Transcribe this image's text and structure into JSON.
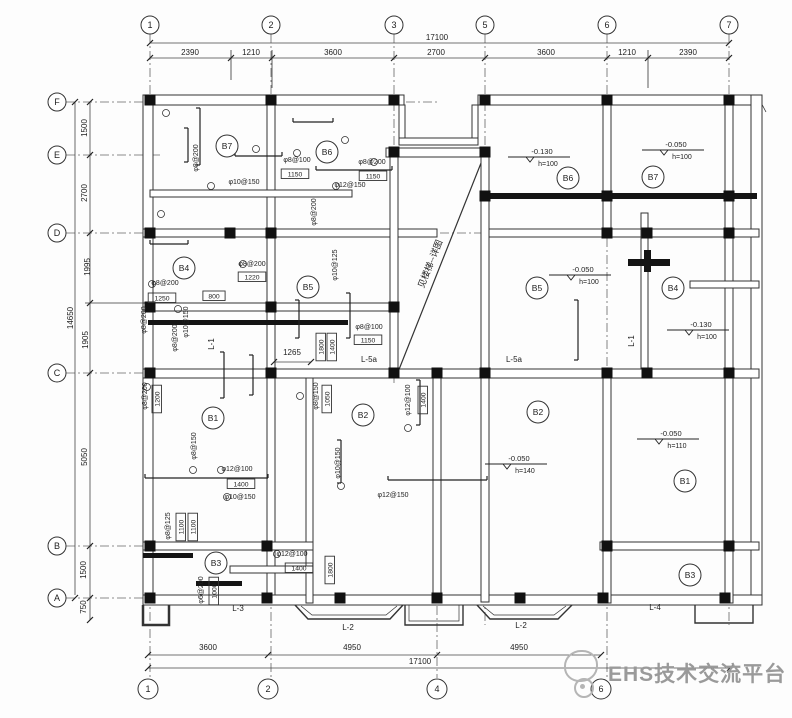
{
  "watermark": {
    "text": "EHS技术交流平台"
  },
  "drawing": {
    "gridlines": [
      [
        150,
        34,
        150,
        678
      ],
      [
        271,
        34,
        271,
        678
      ],
      [
        394,
        34,
        394,
        386
      ],
      [
        437,
        368,
        437,
        678
      ],
      [
        485,
        34,
        485,
        625
      ],
      [
        607,
        34,
        607,
        678
      ],
      [
        729,
        34,
        729,
        625
      ],
      [
        66,
        102,
        437,
        102
      ],
      [
        66,
        155,
        163,
        155
      ],
      [
        66,
        233,
        760,
        233
      ],
      [
        66,
        373,
        760,
        373
      ],
      [
        66,
        546,
        313,
        546
      ],
      [
        66,
        598,
        762,
        598
      ]
    ],
    "dimlines": [
      [
        150,
        43,
        729,
        43
      ],
      [
        150,
        58,
        729,
        58
      ],
      [
        148,
        655,
        601,
        655
      ],
      [
        148,
        668,
        730,
        668
      ],
      [
        90,
        102,
        90,
        620
      ],
      [
        75,
        102,
        75,
        595
      ],
      [
        274,
        362,
        311,
        362
      ]
    ],
    "lines": [
      [
        757,
        95,
        766,
        112
      ],
      [
        485,
        153,
        398,
        372,
        1.2
      ],
      [
        753,
        189,
        753,
        204,
        2
      ],
      [
        520,
        95,
        520,
        105
      ],
      [
        548,
        95,
        548,
        105
      ],
      [
        630,
        95,
        630,
        105
      ],
      [
        658,
        95,
        658,
        105
      ],
      [
        700,
        95,
        700,
        105
      ],
      [
        340,
        95,
        340,
        105
      ],
      [
        365,
        95,
        365,
        105
      ],
      [
        215,
        95,
        215,
        105
      ],
      [
        240,
        95,
        240,
        105
      ],
      [
        143,
        130,
        153,
        130
      ],
      [
        143,
        160,
        153,
        160
      ],
      [
        143,
        410,
        153,
        410
      ],
      [
        143,
        440,
        153,
        440
      ],
      [
        143,
        470,
        153,
        470
      ],
      [
        751,
        300,
        762,
        300
      ],
      [
        751,
        330,
        762,
        330
      ],
      [
        751,
        470,
        762,
        470
      ],
      [
        751,
        500,
        762,
        500
      ],
      [
        231,
        50,
        231,
        80
      ],
      [
        272,
        50,
        272,
        88
      ],
      [
        648,
        50,
        648,
        88
      ],
      [
        85,
        303,
        148,
        303
      ]
    ],
    "walls": [
      [
        143,
        95,
        261,
        10
      ],
      [
        386,
        148,
        103,
        9
      ],
      [
        399,
        105,
        6,
        38
      ],
      [
        472,
        105,
        6,
        38
      ],
      [
        399,
        138,
        79,
        7
      ],
      [
        478,
        95,
        284,
        10
      ],
      [
        751,
        95,
        11,
        510
      ],
      [
        143,
        95,
        10,
        510
      ],
      [
        143,
        595,
        619,
        10
      ],
      [
        267,
        105,
        8,
        490
      ],
      [
        150,
        190,
        202,
        7
      ],
      [
        143,
        229,
        294,
        8
      ],
      [
        485,
        229,
        274,
        8
      ],
      [
        143,
        303,
        255,
        8
      ],
      [
        390,
        150,
        8,
        228
      ],
      [
        481,
        150,
        8,
        452
      ],
      [
        603,
        105,
        8,
        130
      ],
      [
        603,
        373,
        8,
        230
      ],
      [
        641,
        213,
        7,
        163
      ],
      [
        725,
        105,
        8,
        498
      ],
      [
        143,
        369,
        616,
        9
      ],
      [
        433,
        378,
        8,
        225
      ],
      [
        306,
        378,
        7,
        225
      ],
      [
        143,
        542,
        170,
        8
      ],
      [
        600,
        542,
        159,
        8
      ],
      [
        230,
        566,
        83,
        7
      ],
      [
        690,
        281,
        69,
        7
      ]
    ],
    "solids": [
      [
        480,
        193,
        277,
        6
      ],
      [
        148,
        320,
        200,
        5
      ],
      [
        143,
        553,
        50,
        5
      ],
      [
        196,
        581,
        46,
        5
      ],
      [
        628,
        259,
        42,
        7
      ],
      [
        644,
        250,
        7,
        22
      ]
    ],
    "columns": [
      [
        150,
        100
      ],
      [
        271,
        100
      ],
      [
        394,
        100
      ],
      [
        485,
        100
      ],
      [
        607,
        100
      ],
      [
        729,
        100
      ],
      [
        394,
        152
      ],
      [
        485,
        152
      ],
      [
        485,
        196
      ],
      [
        607,
        196
      ],
      [
        729,
        196
      ],
      [
        150,
        233
      ],
      [
        230,
        233
      ],
      [
        271,
        233
      ],
      [
        607,
        233
      ],
      [
        647,
        233
      ],
      [
        729,
        233
      ],
      [
        150,
        307
      ],
      [
        271,
        307
      ],
      [
        394,
        307
      ],
      [
        150,
        373
      ],
      [
        271,
        373
      ],
      [
        394,
        373
      ],
      [
        437,
        373
      ],
      [
        485,
        373
      ],
      [
        607,
        373
      ],
      [
        647,
        373
      ],
      [
        729,
        373
      ],
      [
        150,
        546
      ],
      [
        267,
        546
      ],
      [
        607,
        546
      ],
      [
        729,
        546
      ],
      [
        150,
        598
      ],
      [
        267,
        598
      ],
      [
        340,
        598
      ],
      [
        437,
        598
      ],
      [
        520,
        598
      ],
      [
        603,
        598
      ],
      [
        725,
        598
      ]
    ],
    "polys": [
      {
        "w": 2.5,
        "pts": [
          [
            143,
            605
          ],
          [
            143,
            625
          ],
          [
            169,
            625
          ],
          [
            169,
            605
          ]
        ]
      },
      {
        "w": 1.4,
        "pts": [
          [
            295,
            605
          ],
          [
            308,
            619
          ],
          [
            390,
            619
          ],
          [
            403,
            605
          ]
        ]
      },
      {
        "w": 0.7,
        "pts": [
          [
            301,
            606
          ],
          [
            312,
            615
          ],
          [
            386,
            615
          ],
          [
            397,
            606
          ]
        ]
      },
      {
        "w": 1.4,
        "pts": [
          [
            405,
            605
          ],
          [
            405,
            625
          ],
          [
            463,
            625
          ],
          [
            463,
            605
          ]
        ]
      },
      {
        "w": 0.7,
        "pts": [
          [
            409,
            605
          ],
          [
            409,
            621
          ],
          [
            459,
            621
          ],
          [
            459,
            605
          ]
        ]
      },
      {
        "w": 1.4,
        "pts": [
          [
            477,
            605
          ],
          [
            490,
            619
          ],
          [
            558,
            619
          ],
          [
            572,
            605
          ]
        ]
      },
      {
        "w": 0.7,
        "pts": [
          [
            483,
            606
          ],
          [
            494,
            615
          ],
          [
            554,
            615
          ],
          [
            566,
            606
          ]
        ]
      },
      {
        "w": 1.4,
        "pts": [
          [
            695,
            605
          ],
          [
            695,
            623
          ],
          [
            753,
            623
          ],
          [
            753,
            605
          ]
        ]
      }
    ],
    "hooks": [
      [
        150,
        244,
        188,
        244
      ],
      [
        235,
        156,
        282,
        156
      ],
      [
        316,
        170,
        392,
        170
      ],
      [
        145,
        478,
        268,
        478
      ],
      [
        293,
        122,
        333,
        122
      ],
      [
        388,
        480,
        487,
        480
      ],
      [
        200,
        108,
        200,
        165
      ],
      [
        224,
        352,
        224,
        398
      ],
      [
        253,
        355,
        253,
        395
      ],
      [
        299,
        300,
        299,
        338
      ],
      [
        350,
        293,
        350,
        338
      ],
      [
        578,
        300,
        578,
        360
      ],
      [
        188,
        128,
        188,
        162
      ],
      [
        341,
        440,
        341,
        483
      ],
      [
        420,
        380,
        420,
        425
      ]
    ],
    "ticks": [
      [
        150,
        43
      ],
      [
        729,
        43
      ],
      [
        150,
        58
      ],
      [
        231,
        58
      ],
      [
        272,
        58
      ],
      [
        394,
        58
      ],
      [
        485,
        58
      ],
      [
        607,
        58
      ],
      [
        648,
        58
      ],
      [
        729,
        58
      ],
      [
        148,
        655
      ],
      [
        268,
        655
      ],
      [
        437,
        655
      ],
      [
        601,
        655
      ],
      [
        148,
        668
      ],
      [
        730,
        668
      ],
      [
        90,
        102
      ],
      [
        90,
        155
      ],
      [
        90,
        233
      ],
      [
        90,
        303
      ],
      [
        90,
        373
      ],
      [
        90,
        546
      ],
      [
        90,
        598
      ],
      [
        90,
        620
      ],
      [
        75,
        102
      ],
      [
        75,
        598
      ],
      [
        274,
        362
      ],
      [
        311,
        362
      ]
    ],
    "refs": [
      [
        166,
        113
      ],
      [
        256,
        149
      ],
      [
        211,
        186
      ],
      [
        161,
        214
      ],
      [
        297,
        153
      ],
      [
        345,
        140
      ],
      [
        243,
        264
      ],
      [
        152,
        284
      ],
      [
        178,
        309
      ],
      [
        147,
        387
      ],
      [
        193,
        470
      ],
      [
        221,
        470
      ],
      [
        227,
        497
      ],
      [
        277,
        554
      ],
      [
        300,
        396
      ],
      [
        341,
        486
      ],
      [
        374,
        162
      ],
      [
        336,
        186
      ],
      [
        408,
        428
      ]
    ],
    "bubbles": [
      [
        150,
        25,
        9,
        "1"
      ],
      [
        271,
        25,
        9,
        "2"
      ],
      [
        394,
        25,
        9,
        "3"
      ],
      [
        485,
        25,
        9,
        "5"
      ],
      [
        607,
        25,
        9,
        "6"
      ],
      [
        729,
        25,
        9,
        "7"
      ],
      [
        148,
        689,
        10,
        "1"
      ],
      [
        268,
        689,
        10,
        "2"
      ],
      [
        437,
        689,
        10,
        "4"
      ],
      [
        601,
        689,
        10,
        "6"
      ],
      [
        57,
        102,
        9,
        "F"
      ],
      [
        57,
        155,
        9,
        "E"
      ],
      [
        57,
        233,
        9,
        "D"
      ],
      [
        57,
        373,
        9,
        "C"
      ],
      [
        57,
        546,
        9,
        "B"
      ],
      [
        57,
        598,
        9,
        "A"
      ]
    ],
    "rooms": [
      [
        227,
        146,
        "B7"
      ],
      [
        327,
        152,
        "B6"
      ],
      [
        184,
        268,
        "B4"
      ],
      [
        308,
        287,
        "B5"
      ],
      [
        213,
        418,
        "B1"
      ],
      [
        363,
        415,
        "B2"
      ],
      [
        216,
        563,
        "B3"
      ],
      [
        568,
        178,
        "B6"
      ],
      [
        653,
        177,
        "B7"
      ],
      [
        537,
        288,
        "B5"
      ],
      [
        673,
        288,
        "B4"
      ],
      [
        538,
        412,
        "B2"
      ],
      [
        685,
        481,
        "B1"
      ],
      [
        690,
        575,
        "B3"
      ]
    ],
    "texts": [
      [
        437,
        40,
        "17100"
      ],
      [
        190,
        55,
        "2390"
      ],
      [
        251,
        55,
        "1210"
      ],
      [
        333,
        55,
        "3600"
      ],
      [
        436,
        55,
        "2700"
      ],
      [
        546,
        55,
        "3600"
      ],
      [
        627,
        55,
        "1210"
      ],
      [
        688,
        55,
        "2390"
      ],
      [
        208,
        650,
        "3600"
      ],
      [
        352,
        650,
        "4950"
      ],
      [
        519,
        650,
        "4950"
      ],
      [
        420,
        664,
        "17100"
      ],
      [
        87,
        128,
        "1500",
        -90
      ],
      [
        87,
        193,
        "2700",
        -90
      ],
      [
        90,
        267,
        "1995",
        -90
      ],
      [
        88,
        340,
        "1905",
        -90
      ],
      [
        87,
        457,
        "5050",
        -90
      ],
      [
        86,
        570,
        "1500",
        -90
      ],
      [
        86,
        607,
        "750",
        -90
      ],
      [
        73,
        318,
        "14650",
        -90
      ],
      [
        292,
        355,
        "1265"
      ],
      [
        214,
        344,
        "L-1",
        -90
      ],
      [
        634,
        341,
        "L-1",
        -90
      ],
      [
        369,
        362,
        "L-5a"
      ],
      [
        514,
        362,
        "L-5a"
      ],
      [
        348,
        630,
        "L-2"
      ],
      [
        521,
        628,
        "L-2"
      ],
      [
        238,
        611,
        "L-3"
      ],
      [
        655,
        610,
        "L-4"
      ],
      [
        198,
        158,
        "φ8@200",
        -90,
        7
      ],
      [
        244,
        184,
        "φ10@150",
        0,
        7
      ],
      [
        297,
        162,
        "φ8@100",
        0,
        7
      ],
      [
        372,
        164,
        "φ8@200",
        0,
        7
      ],
      [
        350,
        187,
        "φ12@150",
        0,
        7
      ],
      [
        252,
        266,
        "φ8@200",
        0,
        7
      ],
      [
        337,
        265,
        "φ10@125",
        -90,
        7
      ],
      [
        165,
        285,
        "φ8@200",
        0,
        7
      ],
      [
        177,
        338,
        "φ8@200",
        -90,
        7
      ],
      [
        188,
        322,
        "φ10@150",
        -90,
        7
      ],
      [
        146,
        320,
        "φ8@200",
        -90,
        7
      ],
      [
        147,
        396,
        "φ8@200",
        -90,
        7
      ],
      [
        196,
        446,
        "φ8@150",
        -90,
        7
      ],
      [
        318,
        396,
        "φ8@150",
        -90,
        7
      ],
      [
        237,
        471,
        "φ12@100",
        0,
        7
      ],
      [
        240,
        499,
        "φ10@150",
        0,
        7
      ],
      [
        292,
        556,
        "φ12@100",
        0,
        7
      ],
      [
        203,
        590,
        "φ6@200",
        -90,
        7
      ],
      [
        170,
        526,
        "φ8@125",
        -90,
        7
      ],
      [
        340,
        463,
        "φ10@150",
        -90,
        7
      ],
      [
        393,
        497,
        "φ12@150",
        0,
        7
      ],
      [
        410,
        400,
        "φ12@100",
        -90,
        7
      ],
      [
        316,
        212,
        "φ8@200",
        -90,
        7
      ],
      [
        369,
        329,
        "φ8@100",
        0,
        7
      ],
      [
        433,
        265,
        "见楼梯--详图",
        -68,
        9
      ]
    ],
    "boxes": [
      [
        295,
        174,
        "1150"
      ],
      [
        373,
        176,
        "1150"
      ],
      [
        252,
        277,
        "1220"
      ],
      [
        162,
        298,
        "1250"
      ],
      [
        214,
        296,
        "800"
      ],
      [
        157,
        399,
        "1200",
        -90
      ],
      [
        327,
        399,
        "1050",
        -90
      ],
      [
        241,
        484,
        "1400"
      ],
      [
        299,
        568,
        "1400"
      ],
      [
        214,
        591,
        "1000",
        -90
      ],
      [
        181,
        527,
        "1100",
        -90
      ],
      [
        193,
        527,
        "1100",
        -90
      ],
      [
        321,
        347,
        "1800",
        -90
      ],
      [
        332,
        347,
        "1400",
        -90
      ],
      [
        423,
        400,
        "1400",
        -90
      ],
      [
        330,
        570,
        "1800",
        -90
      ],
      [
        368,
        340,
        "1150"
      ]
    ],
    "elevations": [
      [
        530,
        157,
        "-0.130",
        "h=100"
      ],
      [
        664,
        150,
        "-0.050",
        "h=100"
      ],
      [
        571,
        275,
        "-0.050",
        "h=100"
      ],
      [
        689,
        330,
        "-0.130",
        "h=100"
      ],
      [
        507,
        464,
        "-0.050",
        "h=140"
      ],
      [
        659,
        439,
        "-0.050",
        "h=110"
      ]
    ]
  }
}
